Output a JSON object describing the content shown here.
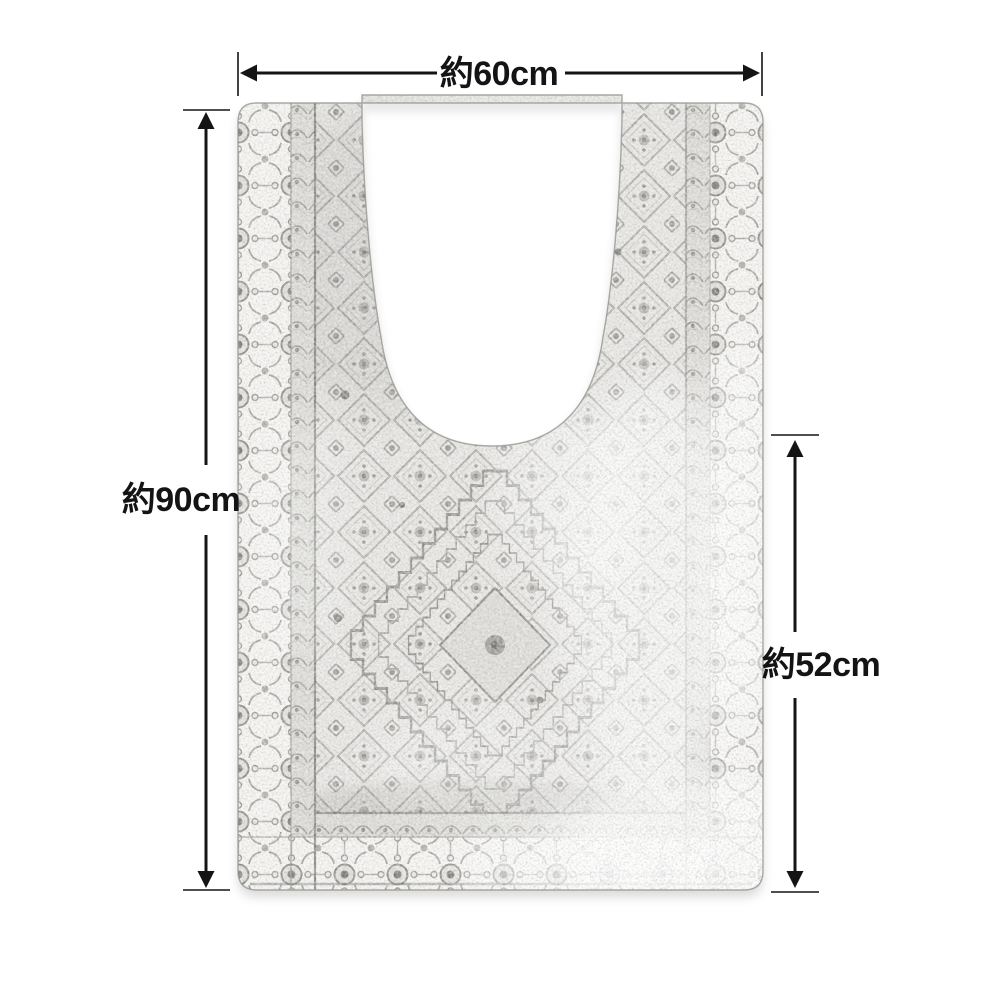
{
  "diagram": {
    "type": "product-dimension-diagram",
    "subject": "vintage-pattern-toilet-mat-with-u-cutout",
    "dimensions": {
      "width": {
        "label": "約60cm"
      },
      "height": {
        "label": "約90cm"
      },
      "cutout_side_height": {
        "label": "約52cm"
      }
    },
    "colors": {
      "background": "#ffffff",
      "annotation": "#141414",
      "mat_base": "#e4e3e0",
      "mat_border_background": "#f4f3f0",
      "motif_gray": "#8a8985",
      "motif_dark": "#56554f"
    }
  }
}
